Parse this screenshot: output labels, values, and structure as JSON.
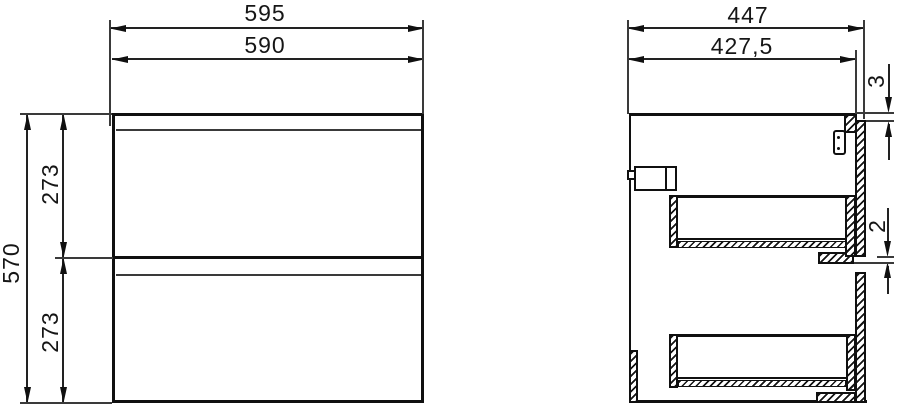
{
  "drawing": {
    "type": "technical-dimension-drawing",
    "views": [
      "front",
      "side"
    ]
  },
  "dimensions": {
    "front_view": {
      "overall_width": "595",
      "body_width": "590",
      "overall_height": "570",
      "upper_front_height": "273",
      "lower_front_height": "273"
    },
    "side_view": {
      "overall_depth": "447",
      "body_depth": "427,5",
      "top_gap": "3",
      "front_gap": "2"
    }
  },
  "colors": {
    "line": "#101010",
    "background": "#ffffff"
  }
}
